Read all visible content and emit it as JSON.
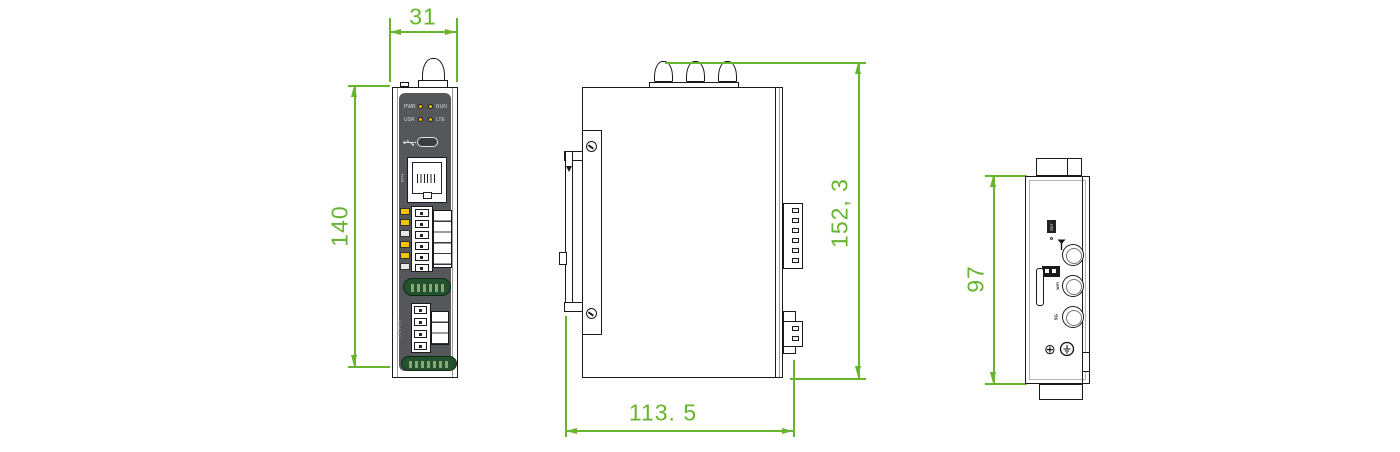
{
  "drawing": {
    "title": "industrial-din-rail-router-dimension-drawing",
    "views": [
      "front",
      "side",
      "end"
    ]
  },
  "colors": {
    "dimension_green": "#67b42f",
    "outline": "#1a1a1a",
    "front_panel_gray": "#55575b",
    "led_yellow": "#f0c400",
    "connector_green": "#24522e"
  },
  "dimensions": {
    "front_width": "31",
    "front_height": "140",
    "overall_height": "152, 3",
    "side_width": "113. 5",
    "depth": "97"
  },
  "front_view": {
    "leds": [
      {
        "label": "PWR"
      },
      {
        "label": "RUN"
      },
      {
        "label": "USR"
      },
      {
        "label": "LTE"
      }
    ],
    "eth_label": "ETH",
    "power_label": "DC 9-36V"
  },
  "end_view": {
    "reset_label": "RST",
    "wifi_label": "WIFI",
    "cell_label": "5G"
  }
}
